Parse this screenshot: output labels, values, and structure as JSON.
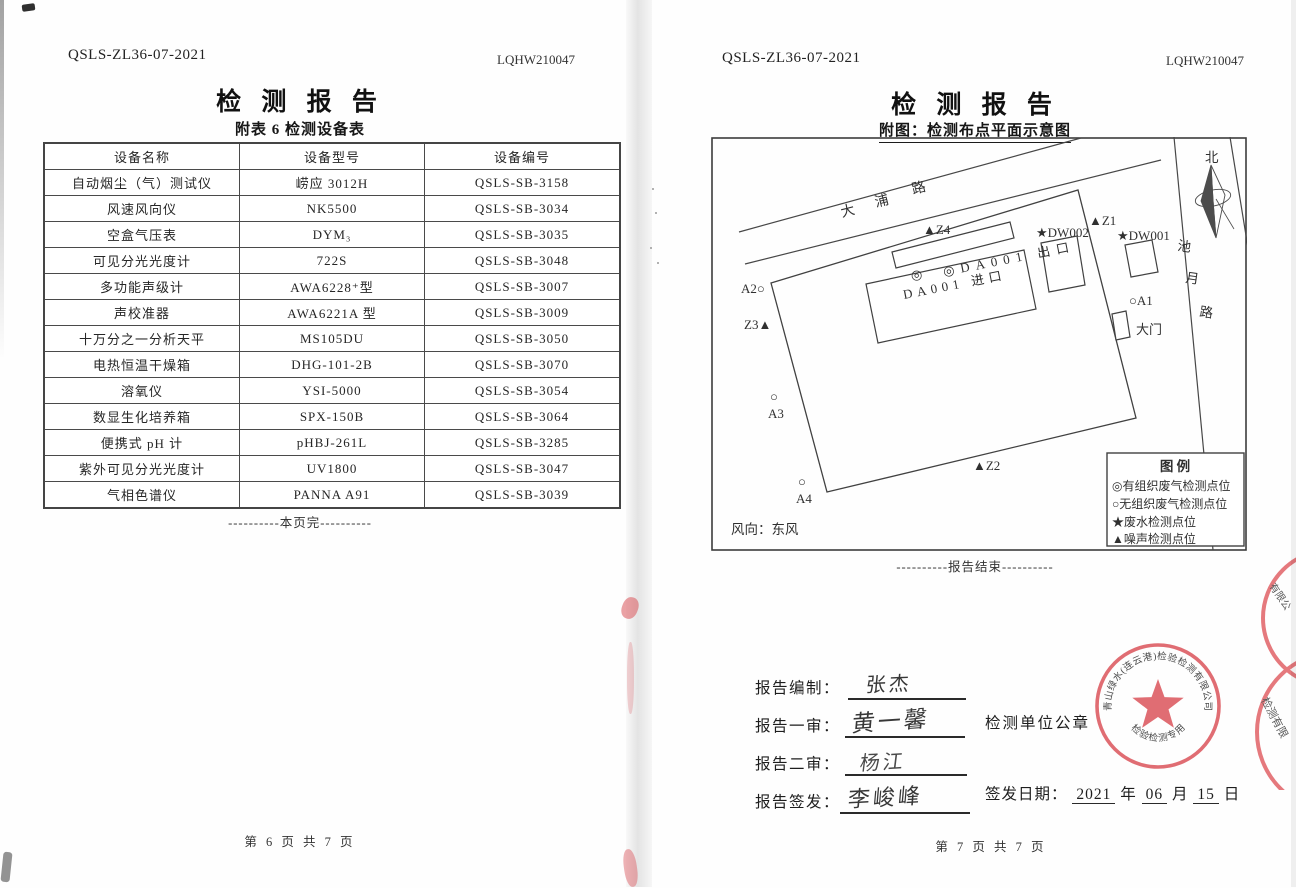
{
  "left_page": {
    "doc_code": "QSLS-ZL36-07-2021",
    "report_no": "LQHW210047",
    "title": "检 测 报 告",
    "subtitle": "附表 6 检测设备表",
    "table": {
      "headers": [
        "设备名称",
        "设备型号",
        "设备编号"
      ],
      "rows": [
        [
          "自动烟尘（气）测试仪",
          "崂应 3012H",
          "QSLS-SB-3158"
        ],
        [
          "风速风向仪",
          "NK5500",
          "QSLS-SB-3034"
        ],
        [
          "空盒气压表",
          "DYM₃",
          "QSLS-SB-3035"
        ],
        [
          "可见分光光度计",
          "722S",
          "QSLS-SB-3048"
        ],
        [
          "多功能声级计",
          "AWA6228⁺型",
          "QSLS-SB-3007"
        ],
        [
          "声校准器",
          "AWA6221A 型",
          "QSLS-SB-3009"
        ],
        [
          "十万分之一分析天平",
          "MS105DU",
          "QSLS-SB-3050"
        ],
        [
          "电热恒温干燥箱",
          "DHG-101-2B",
          "QSLS-SB-3070"
        ],
        [
          "溶氧仪",
          "YSI-5000",
          "QSLS-SB-3054"
        ],
        [
          "数显生化培养箱",
          "SPX-150B",
          "QSLS-SB-3064"
        ],
        [
          "便携式 pH 计",
          "pHBJ-261L",
          "QSLS-SB-3285"
        ],
        [
          "紫外可见分光光度计",
          "UV1800",
          "QSLS-SB-3047"
        ],
        [
          "气相色谱仪",
          "PANNA A91",
          "QSLS-SB-3039"
        ]
      ]
    },
    "end_note": "----------本页完----------",
    "footer": "第 6 页 共 7 页"
  },
  "right_page": {
    "doc_code": "QSLS-ZL36-07-2021",
    "report_no": "LQHW210047",
    "title": "检 测 报 告",
    "subtitle": "附图：检测布点平面示意图",
    "diagram": {
      "north_label": "北",
      "road_top": [
        "大",
        "浦",
        "路"
      ],
      "road_right": [
        "池",
        "月",
        "路"
      ],
      "points": {
        "z4": "▲Z4",
        "z1": "▲Z1",
        "dw002": "★DW002",
        "dw001": "★DW001",
        "outlet_sym": "◎",
        "outlet": "◎DA001 出口",
        "inlet": "DA001 进口",
        "a2": "A2○",
        "a1": "○A1",
        "z3": "Z3▲",
        "gate": "大门",
        "a3_sym": "○",
        "a3": "A3",
        "z2": "▲Z2",
        "a4_sym": "○",
        "a4": "A4"
      },
      "legend": {
        "title": "图  例",
        "items": [
          "◎有组织废气检测点位",
          "○无组织废气检测点位",
          "★废水检测点位",
          "▲噪声检测点位"
        ]
      },
      "wind": "风向：东风"
    },
    "end_note": "----------报告结束----------",
    "signatures": [
      {
        "label": "报告编制：",
        "name": "张杰"
      },
      {
        "label": "报告一审：",
        "name": "黄一馨"
      },
      {
        "label": "报告二审：",
        "name": "杨江"
      },
      {
        "label": "报告签发：",
        "name": "李峻峰"
      }
    ],
    "seal_label": "检测单位公章",
    "issue_date": {
      "label": "签发日期：",
      "year": "2021",
      "year_unit": "年",
      "month": "06",
      "month_unit": "月",
      "day": "15",
      "day_unit": "日"
    },
    "stamp": {
      "ring_text": "青山绿水(连云港)检验检测有限公司",
      "center_text": "检验检测专用章",
      "color": "#dd5a60"
    },
    "edge_stamp_fragments": [
      "有限公",
      "检测有限"
    ],
    "footer": "第 7 页 共 7 页"
  }
}
